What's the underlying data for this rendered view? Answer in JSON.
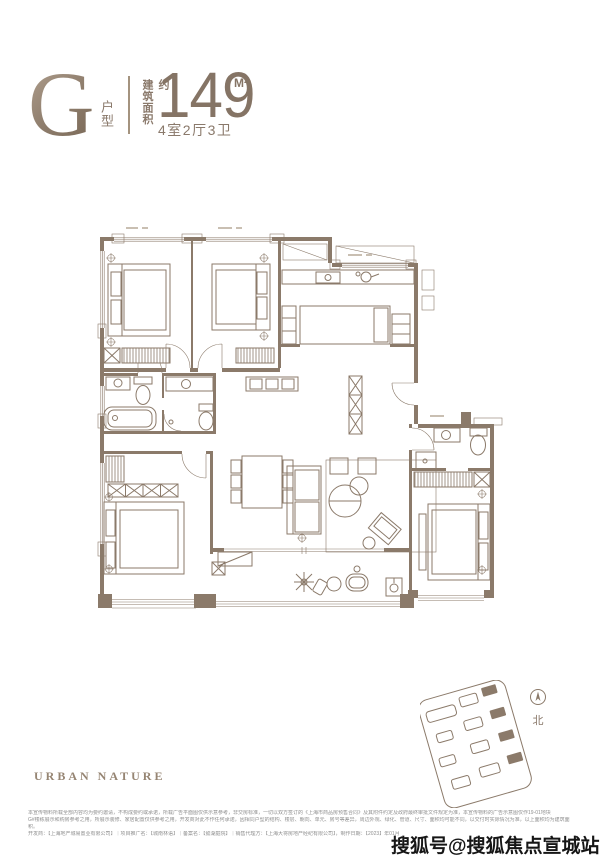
{
  "header": {
    "type_letter": "G",
    "type_suffix": "户型",
    "area_label": "建筑面积约",
    "area_value": "149",
    "area_unit": "M²",
    "rooms": "4室2厅3卫"
  },
  "brand": "URBAN NATURE",
  "siteplan": {
    "north_label": "北"
  },
  "watermark": "搜狐号@搜狐焦点宣城站",
  "disclaimer": {
    "lines": [
      "本宣传物料所载全部内容均为要约邀请，不构成要约或承诺，所载广告平面图仅供示意参考，非交房标准，一切以双方签订的《上海市商品房预售合同》及其附件约定及政府最终审批文件规定为准，本宣传物料的广告示意图仅作19-01地块",
      "G#楼栋展示和购房参考之用，所展示装修、家居配置仅供参考之用，开发商对此不作任何承诺，因相同户型的结构、楼层、朝向、单元、房号等差异，周边外观、绿化、管道、尺寸、面积均可能不同，以交付时实际情况为准，以上面积均为建筑面",
      "积。",
      "开发商：【上海地产城易置业有限公司】｜项目推广名：【城南林语】｜备案名：【懿湖庭院】｜销售代理方：【上海大将房地产经纪有限公司】，制作日期：【2023】年01月"
    ]
  },
  "colors": {
    "plan_line": "#8b7a6a",
    "header_text": "#8a796b",
    "disclaimer_text": "#8f8f8f",
    "watermark_text": "#161616"
  },
  "icons": {
    "floorplan": "apartment-floor-plan",
    "siteplan": "site-location-map",
    "north": "north-compass"
  }
}
